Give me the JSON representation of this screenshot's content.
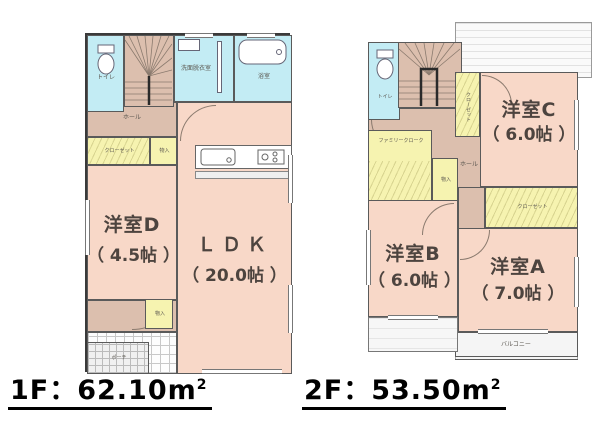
{
  "colors": {
    "room_pink": "#f8d8c8",
    "closet_yellow": "#f6f3b0",
    "wet_cyan": "#c3ecf4",
    "stair_tan": "#dcbfae",
    "wall": "#5a5a5a",
    "label_text": "#4d443f",
    "area_text": "#000000"
  },
  "floors": [
    {
      "id": "1F",
      "area_label": {
        "text": "1F：62.10m",
        "sup": "2"
      },
      "rooms": [
        {
          "id": "yoshitsu-d",
          "name": "洋室D",
          "size": "（ 4.5帖 ）"
        },
        {
          "id": "ldk",
          "name": "ＬＤＫ",
          "size": "（ 20.0帖 ）"
        }
      ],
      "small_labels": {
        "toilet": "トイレ",
        "hall": "ホール",
        "washroom": "洗面脱衣室",
        "bath": "浴室",
        "closet": "クローゼット",
        "storage": "物入",
        "entrance": "玄関",
        "porch": "ポーチ"
      }
    },
    {
      "id": "2F",
      "area_label": {
        "text": "2F：53.50m",
        "sup": "2"
      },
      "rooms": [
        {
          "id": "yoshitsu-c",
          "name": "洋室C",
          "size": "（ 6.0帖 ）"
        },
        {
          "id": "yoshitsu-b",
          "name": "洋室B",
          "size": "（ 6.0帖 ）"
        },
        {
          "id": "yoshitsu-a",
          "name": "洋室A",
          "size": "（ 7.0帖 ）"
        }
      ],
      "small_labels": {
        "toilet": "トイレ",
        "hall": "ホール",
        "family_cloak": "ファミリークローク",
        "closet": "クローゼット",
        "storage": "物入",
        "balcony": "バルコニー"
      }
    }
  ]
}
